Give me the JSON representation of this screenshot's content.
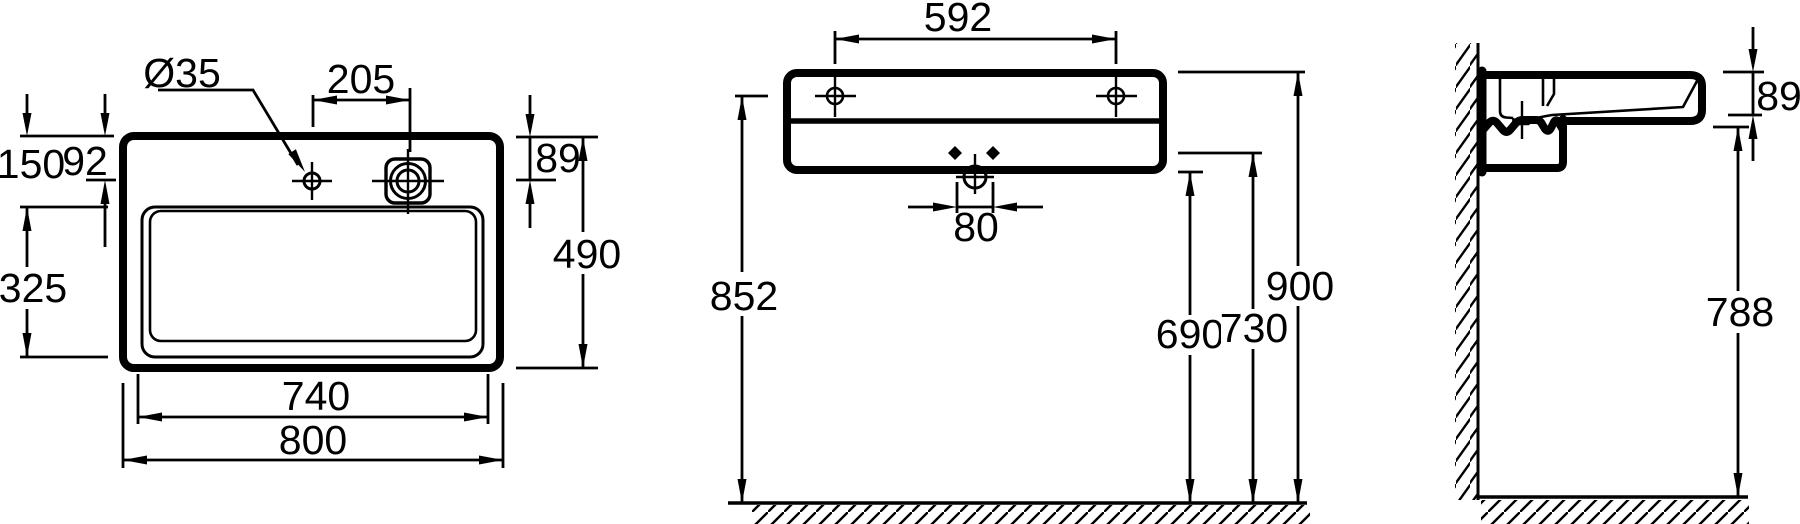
{
  "drawing": {
    "type": "technical-dimension-drawing",
    "subject": "wall-mounted washbasin - plan, front and side section views",
    "line_color": "#000000",
    "background": "#ffffff",
    "views": {
      "plan": {
        "title": "plan view",
        "labels": {
          "tap_hole_diameter": "Ø35",
          "tap_to_drain_spacing": "205",
          "rim_to_bowl_front": "150",
          "rim_to_tap_center": "92",
          "bowl_depth": "325",
          "rim_to_drain_center": "89",
          "overall_depth": "490",
          "bowl_width": "740",
          "overall_width": "800"
        }
      },
      "front": {
        "title": "front view",
        "labels": {
          "fixing_hole_spacing": "592",
          "drain_fixing_spacing": "80",
          "floor_to_fixing_holes": "852",
          "floor_to_underside": "690",
          "floor_to_bracket_holes": "730",
          "floor_to_rim": "900"
        }
      },
      "side": {
        "title": "side section view",
        "labels": {
          "apron_height": "89",
          "floor_to_apron_underside": "788"
        }
      }
    }
  }
}
